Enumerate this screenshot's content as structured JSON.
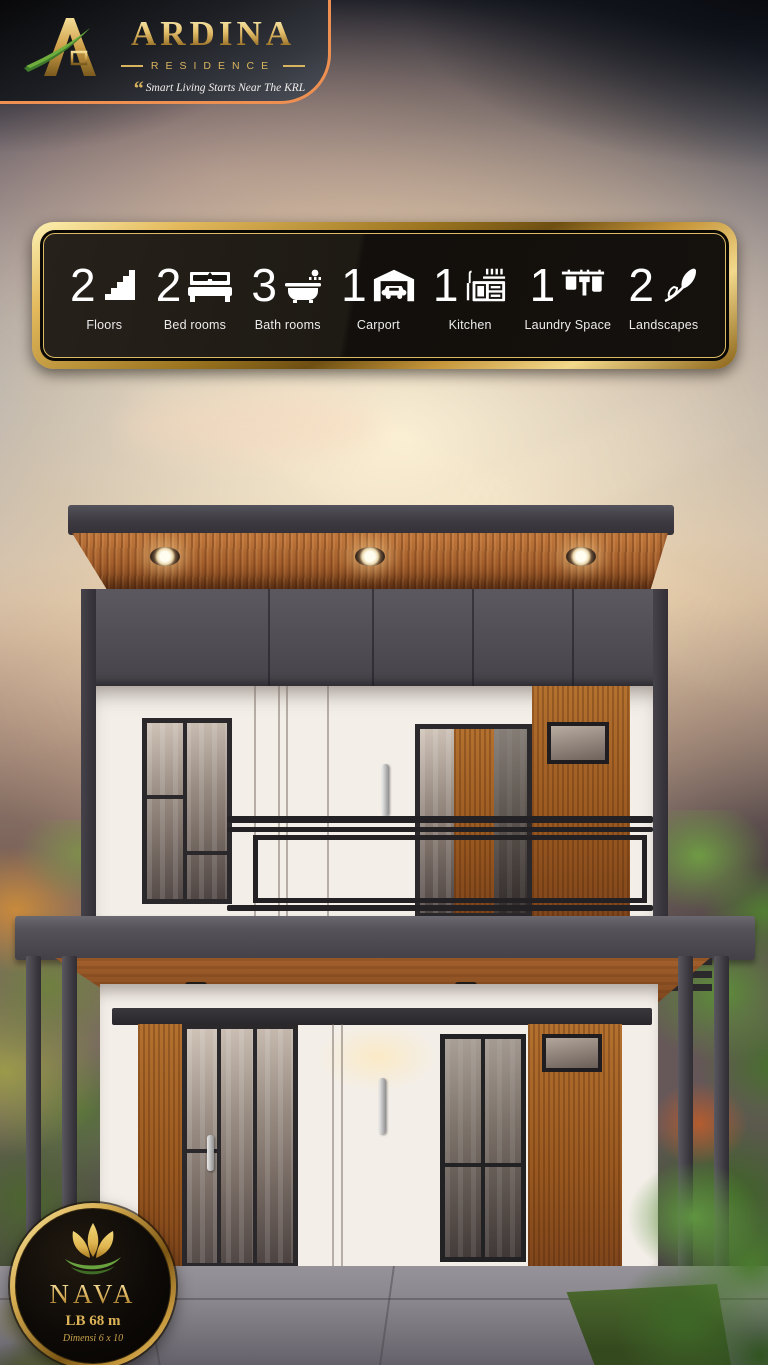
{
  "brand": {
    "name": "ARDINA",
    "sub": "RESIDENCE",
    "quote_mark": "“",
    "tagline": "Smart Living Starts Near The KRL"
  },
  "features": {
    "items": [
      {
        "count": "2",
        "label": "Floors",
        "icon": "stairs-icon"
      },
      {
        "count": "2",
        "label": "Bed rooms",
        "icon": "bed-icon"
      },
      {
        "count": "3",
        "label": "Bath rooms",
        "icon": "bathtub-icon"
      },
      {
        "count": "1",
        "label": "Carport",
        "icon": "carport-icon"
      },
      {
        "count": "1",
        "label": "Kitchen",
        "icon": "kitchen-icon"
      },
      {
        "count": "1",
        "label": "Laundry Space",
        "icon": "laundry-icon"
      },
      {
        "count": "2",
        "label": "Landscapes",
        "icon": "leaf-icon"
      }
    ]
  },
  "badge": {
    "name": "NAVA",
    "building_area": "LB 68 m",
    "dimension": "Dimensi 6 x 10"
  },
  "colors": {
    "gold-light": "#f7e49c",
    "gold": "#d2a74b",
    "gold-deep": "#8a631d",
    "orange-accent": "#ee9051",
    "bar-bg": "#17130f",
    "white-wall": "#f3eee8",
    "roof-gray": "#4b484e",
    "wood": "#a96a33",
    "frame-dark": "#2a282b",
    "green-leaf": "#5f8f3a"
  }
}
